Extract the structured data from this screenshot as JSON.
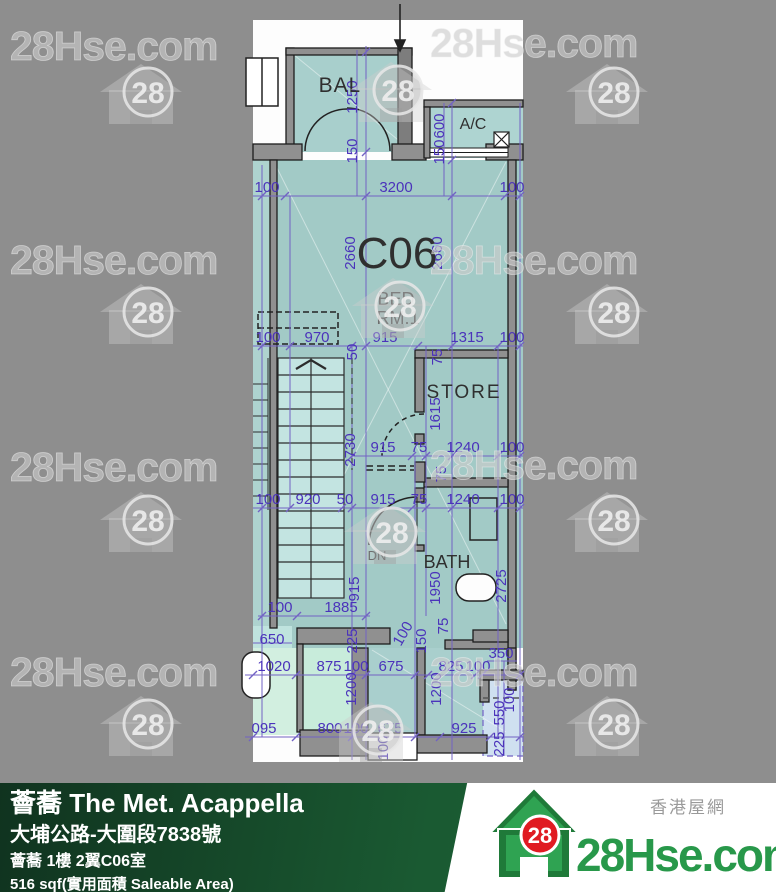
{
  "colors": {
    "background_gray": "#8e8e8e",
    "sheet_white": "#fdfdfd",
    "room_teal": "#a2cac6",
    "stair_teal": "#c3e4e1",
    "mint_green": "#d2efe0",
    "light_blue": "#cfe0f0",
    "dim_purple": "#4b33bb",
    "dim_line_purple": "#7262c4",
    "wall_gray": "#909090",
    "footer_green": "#1a5a32",
    "brand_green": "#28984a",
    "brand_red": "#e01b22"
  },
  "watermark": {
    "text": "28Hse.com",
    "logo_number": "28"
  },
  "plan": {
    "unit_label": "C06",
    "labels": {
      "balcony": "BAL",
      "ac": "A/C",
      "bed_line1": "BED",
      "bed_line2": "RM.1",
      "store": "STORE",
      "bath": "BATH",
      "stair_down": "DN"
    },
    "dims": [
      [
        "100",
        267,
        192,
        0
      ],
      [
        "3200",
        396,
        192,
        0
      ],
      [
        "100",
        512,
        192,
        0
      ],
      [
        "100",
        268,
        342,
        0
      ],
      [
        "970",
        317,
        342,
        0
      ],
      [
        "915",
        385,
        342,
        0
      ],
      [
        "1315",
        467,
        342,
        0
      ],
      [
        "100",
        512,
        342,
        0
      ],
      [
        "915",
        383,
        452,
        0
      ],
      [
        "75",
        419,
        452,
        0
      ],
      [
        "1240",
        463,
        452,
        0
      ],
      [
        "100",
        512,
        452,
        0
      ],
      [
        "100",
        268,
        504,
        0
      ],
      [
        "920",
        308,
        504,
        0
      ],
      [
        "50",
        345,
        504,
        0
      ],
      [
        "915",
        383,
        504,
        0
      ],
      [
        "75",
        419,
        504,
        0
      ],
      [
        "1240",
        463,
        504,
        0
      ],
      [
        "100",
        512,
        504,
        0
      ],
      [
        "100",
        280,
        612,
        0
      ],
      [
        "1885",
        341,
        612,
        0
      ],
      [
        "650",
        272,
        644,
        0
      ],
      [
        "1020",
        274,
        671,
        0
      ],
      [
        "875",
        329,
        671,
        0
      ],
      [
        "100",
        356,
        671,
        0
      ],
      [
        "675",
        391,
        671,
        0
      ],
      [
        "825",
        451,
        671,
        0
      ],
      [
        "100",
        478,
        671,
        0
      ],
      [
        "350",
        501,
        658,
        0
      ],
      [
        "095",
        264,
        733,
        0
      ],
      [
        "800",
        330,
        733,
        0
      ],
      [
        "100",
        356,
        733,
        0
      ],
      [
        "675",
        390,
        733,
        0
      ],
      [
        "925",
        464,
        733,
        0
      ],
      [
        "1250",
        357,
        97,
        -90
      ],
      [
        "150",
        357,
        151,
        -90
      ],
      [
        "600",
        444,
        126,
        -90
      ],
      [
        "150",
        444,
        152,
        -90
      ],
      [
        "2660",
        355,
        253,
        -90
      ],
      [
        "2660",
        442,
        253,
        -90
      ],
      [
        "50",
        357,
        352,
        -90
      ],
      [
        "75",
        442,
        357,
        -90
      ],
      [
        "1615",
        440,
        414,
        -90
      ],
      [
        "2730",
        355,
        450,
        -90
      ],
      [
        "75",
        446,
        474,
        -90
      ],
      [
        "915",
        359,
        589,
        -90
      ],
      [
        "1950",
        440,
        588,
        -90
      ],
      [
        "75",
        448,
        626,
        -90
      ],
      [
        "2725",
        506,
        586,
        -90
      ],
      [
        "150",
        426,
        641,
        -90
      ],
      [
        "100",
        407,
        636,
        -60
      ],
      [
        "225",
        357,
        641,
        -90
      ],
      [
        "1200",
        356,
        689,
        -90
      ],
      [
        "1200",
        441,
        689,
        -90
      ],
      [
        "100",
        388,
        748,
        -90
      ],
      [
        "550",
        504,
        713,
        -90
      ],
      [
        "225",
        504,
        744,
        -90
      ],
      [
        "100",
        514,
        700,
        -90
      ]
    ]
  },
  "footer": {
    "project_title": "薈蕎 The Met. Acappella",
    "address": "大埔公路-大圍段7838號",
    "unit_info": "薈蕎 1樓 2翼C06室",
    "area_info": "516 sqf(實用面積 Saleable Area)",
    "brand": {
      "name": "28Hse.com",
      "tagline_cn": "香港屋網",
      "logo_number": "28"
    }
  }
}
